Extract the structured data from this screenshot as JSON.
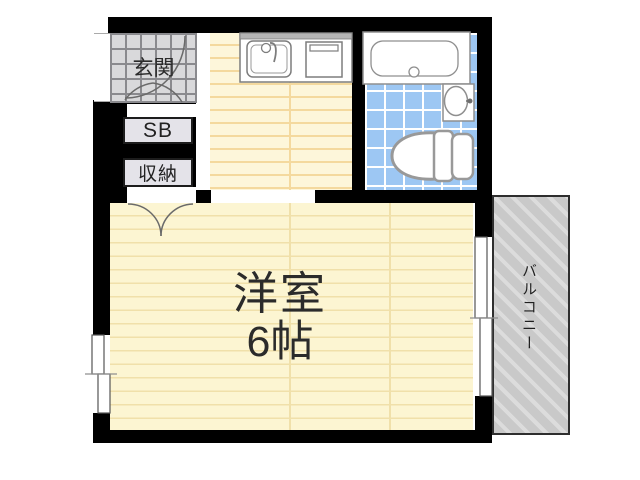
{
  "plan": {
    "type": "japanese-apartment-floor-plan",
    "rooms": {
      "entrance": {
        "label": "玄関"
      },
      "shoe_box": {
        "label": "SB"
      },
      "storage": {
        "label": "収納"
      },
      "main_room": {
        "label": "洋室",
        "size": "6帖"
      },
      "balcony": {
        "label": "バルコニー"
      },
      "kitchen": {
        "label": ""
      },
      "bathroom": {
        "label": ""
      }
    },
    "fixtures": [
      "kitchen-sink-icon",
      "stove-icon",
      "bathtub-icon",
      "washbasin-icon",
      "toilet-icon",
      "entrance-door-swing-icon",
      "closet-door-swing-icon",
      "sliding-window-left",
      "sliding-window-right"
    ],
    "colors": {
      "wall": "#000000",
      "kitchen_floor": "#fdf6da",
      "kitchen_stripe": "#f4d99e",
      "room_floor": "#fcf5d2",
      "room_stripe": "#f0e0aa",
      "bath_tile": "#9dc7f3",
      "tile_grout": "#ffffff",
      "genkan_tile": "#d9d9db",
      "genkan_grout": "#8a8a8e",
      "balcony_fill": "#c9c9c9",
      "balcony_stripe": "#dcdcdc",
      "plate_fill": "#e4e3e9",
      "fixture_stroke": "#8f8f8f"
    }
  }
}
